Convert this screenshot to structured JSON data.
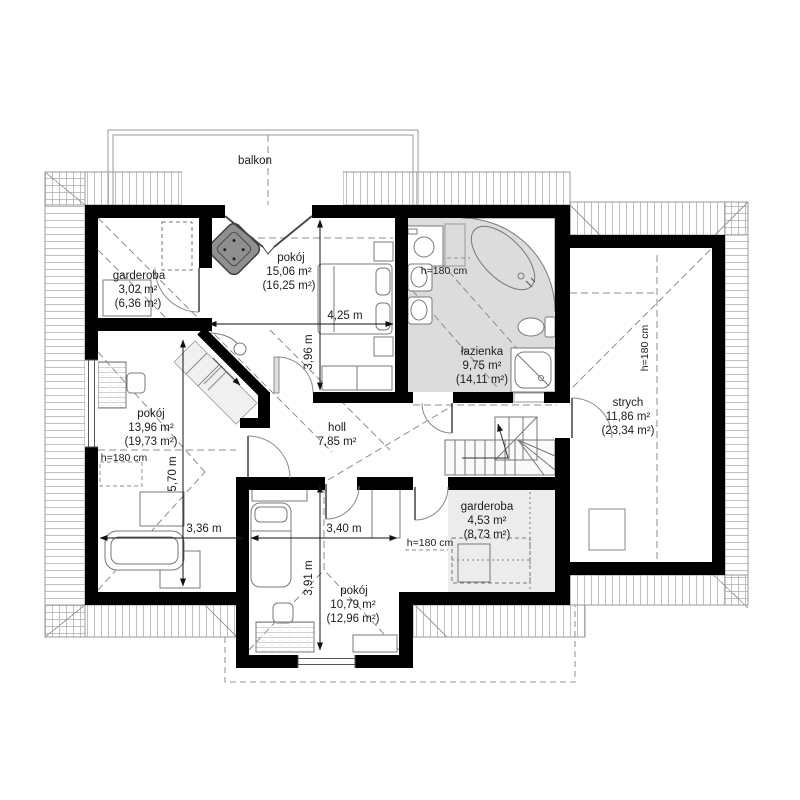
{
  "balcony_label": "balkon",
  "height_note": "h=180 cm",
  "rooms": {
    "wardrobe_top": {
      "name": "garderoba",
      "area": "3,02 m²",
      "area_total": "(6,36 m²)"
    },
    "bedroom_top": {
      "name": "pokój",
      "area": "15,06 m²",
      "area_total": "(16,25 m²)"
    },
    "bathroom": {
      "name": "łazienka",
      "area": "9,75 m²",
      "area_total": "(14,11 m²)"
    },
    "attic": {
      "name": "strych",
      "area": "11,86 m²",
      "area_total": "(23,34 m²)"
    },
    "room_left": {
      "name": "pokój",
      "area": "13,96 m²",
      "area_total": "(19,73 m²)"
    },
    "hall": {
      "name": "holl",
      "area": "7,85 m²"
    },
    "wardrobe_bottom": {
      "name": "garderoba",
      "area": "4,53 m²",
      "area_total": "(8,73 m²)"
    },
    "room_bottom": {
      "name": "pokój",
      "area": "10,79 m²",
      "area_total": "(12,96 m²)"
    }
  },
  "dimensions": {
    "bedroom_width": "4,25 m",
    "bedroom_depth": "3,96 m",
    "room_left_depth": "5,70 m",
    "room_left_width": "3,36 m",
    "room_bottom_width": "3,40 m",
    "room_bottom_depth": "3,91 m"
  },
  "colors": {
    "wall": "#000000",
    "bathroom_floor": "#dcdcdc",
    "wardrobe_floor": "#ececec",
    "stair_floor": "#f0f0f0",
    "armchair": "#8f8f8f"
  }
}
